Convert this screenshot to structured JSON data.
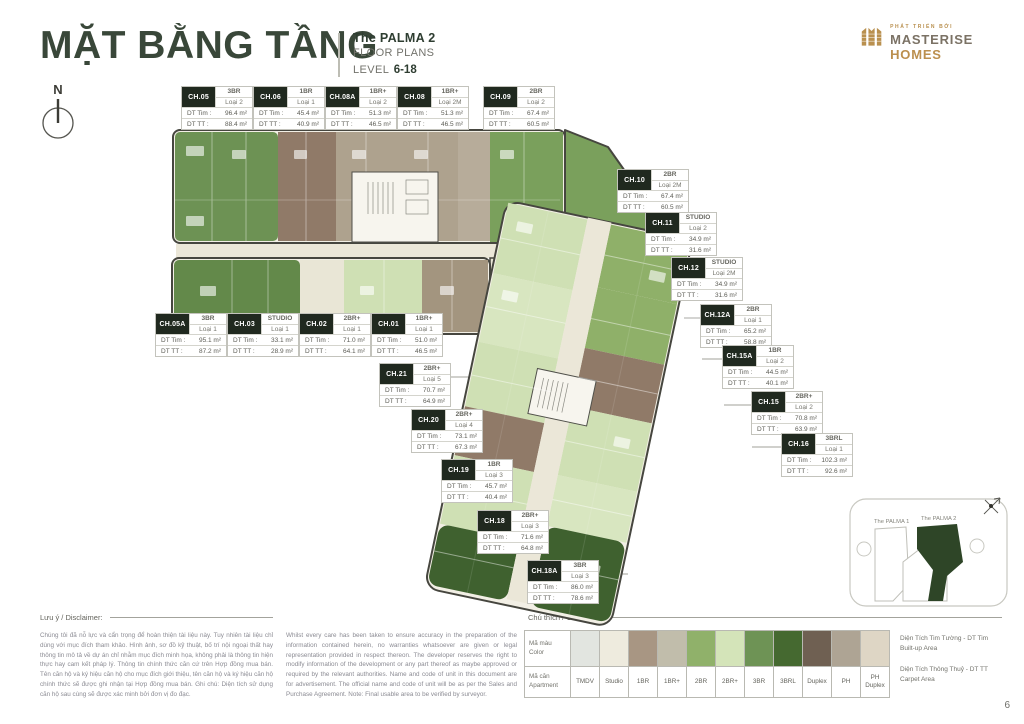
{
  "header": {
    "title": "MẶT BẰNG TẦNG",
    "project_name": "The PALMA 2",
    "subtitle": "FLOOR PLANS",
    "level_label": "LEVEL",
    "level_range": "6-18",
    "logo": {
      "tagline": "PHÁT TRIỂN BỞI",
      "brand_primary": "MASTERISE",
      "brand_secondary": "HOMES",
      "gold_color": "#b9904f"
    }
  },
  "compass_label": "N",
  "plan": {
    "dt_tim_label": "DT Tim :",
    "dt_tt_label": "DT TT :",
    "units": [
      {
        "code": "CH.05",
        "type": "3BR",
        "variant": "Loại 2",
        "dt_tim": "96.4 m²",
        "dt_tt": "88.4 m²"
      },
      {
        "code": "CH.06",
        "type": "1BR",
        "variant": "Loại 1",
        "dt_tim": "45.4 m²",
        "dt_tt": "40.9 m²"
      },
      {
        "code": "CH.08A",
        "type": "1BR+",
        "variant": "Loại 2",
        "dt_tim": "51.3 m²",
        "dt_tt": "46.5 m²"
      },
      {
        "code": "CH.08",
        "type": "1BR+",
        "variant": "Loại 2M",
        "dt_tim": "51.3 m²",
        "dt_tt": "46.5 m²"
      },
      {
        "code": "CH.09",
        "type": "2BR",
        "variant": "Loại 2",
        "dt_tim": "67.4 m²",
        "dt_tt": "60.5 m²"
      },
      {
        "code": "CH.10",
        "type": "2BR",
        "variant": "Loại 2M",
        "dt_tim": "67.4 m²",
        "dt_tt": "60.5 m²"
      },
      {
        "code": "CH.11",
        "type": "STUDIO",
        "variant": "Loại 2",
        "dt_tim": "34.9 m²",
        "dt_tt": "31.6 m²"
      },
      {
        "code": "CH.12",
        "type": "STUDIO",
        "variant": "Loại 2M",
        "dt_tim": "34.9 m²",
        "dt_tt": "31.6 m²"
      },
      {
        "code": "CH.12A",
        "type": "2BR",
        "variant": "Loại 1",
        "dt_tim": "65.2 m²",
        "dt_tt": "58.8 m²"
      },
      {
        "code": "CH.15A",
        "type": "1BR",
        "variant": "Loại 2",
        "dt_tim": "44.5 m²",
        "dt_tt": "40.1 m²"
      },
      {
        "code": "CH.15",
        "type": "2BR+",
        "variant": "Loại 2",
        "dt_tim": "70.8 m²",
        "dt_tt": "63.9 m²"
      },
      {
        "code": "CH.16",
        "type": "3BRL",
        "variant": "Loại 1",
        "dt_tim": "102.3 m²",
        "dt_tt": "92.6 m²"
      },
      {
        "code": "CH.05A",
        "type": "3BR",
        "variant": "Loại 1",
        "dt_tim": "95.1 m²",
        "dt_tt": "87.2 m²"
      },
      {
        "code": "CH.03",
        "type": "STUDIO",
        "variant": "Loại 1",
        "dt_tim": "33.1 m²",
        "dt_tt": "28.9 m²"
      },
      {
        "code": "CH.02",
        "type": "2BR+",
        "variant": "Loại 1",
        "dt_tim": "71.0 m²",
        "dt_tt": "64.1 m²"
      },
      {
        "code": "CH.01",
        "type": "1BR+",
        "variant": "Loại 1",
        "dt_tim": "51.0 m²",
        "dt_tt": "46.5 m²"
      },
      {
        "code": "CH.21",
        "type": "2BR+",
        "variant": "Loại 5",
        "dt_tim": "70.7 m²",
        "dt_tt": "64.9 m²"
      },
      {
        "code": "CH.20",
        "type": "2BR+",
        "variant": "Loại 4",
        "dt_tim": "73.1 m²",
        "dt_tt": "67.3 m²"
      },
      {
        "code": "CH.19",
        "type": "1BR",
        "variant": "Loại 3",
        "dt_tim": "45.7 m²",
        "dt_tt": "40.4 m²"
      },
      {
        "code": "CH.18",
        "type": "2BR+",
        "variant": "Loại 3",
        "dt_tim": "71.6 m²",
        "dt_tt": "64.8 m²"
      },
      {
        "code": "CH.18A",
        "type": "3BR",
        "variant": "Loại 3",
        "dt_tim": "86.0 m²",
        "dt_tt": "78.6 m²"
      }
    ]
  },
  "minimap": {
    "palma1_label": "The PALMA 1",
    "palma2_label": "The PALMA 2",
    "highlight_color": "#2e4527"
  },
  "disclaimer": {
    "title": "Lưu ý / Disclaimer:",
    "vietnamese": "Chúng tôi đã nỗ lực và cẩn trọng để hoàn thiện tài liệu này. Tuy nhiên tài liệu chỉ dùng với mục đích tham khảo. Hình ảnh, sơ đồ kỹ thuật, bố trí nội ngoại thất hay thông tin mô tả về dự án chỉ nhằm mục đích minh họa, không phải là thông tin hiện thực hay cam kết pháp lý. Thông tin chính thức căn cứ trên Hợp đồng mua bán. Tên căn hộ và ký hiệu căn hộ cho mục đích giới thiệu, tên căn hộ và ký hiệu căn hộ chính thức sẽ được ghi nhận tại Hợp đồng mua bán. Ghi chú: Diện tích sử dụng căn hộ sau cùng sẽ được xác minh bởi đơn vị đo đạc.",
    "english": "Whilst every care has been taken to ensure accuracy in the preparation of the information contained herein, no warranties whatsoever are given or legal representation provided in respect thereon. The developer reserves the right to modify information of the development or any part thereof as maybe approved or required by the relevant authorities. Name and code of unit in this document are for advertisement. The official name and code of unit will be as per the Sales and Purchase Agreement. Note: Final usable area to be verified by surveyor."
  },
  "legend": {
    "title": "Chú thích / Comment",
    "color_row_label_vi": "Mã màu",
    "color_row_label_en": "Color",
    "apartment_row_label_vi": "Mã căn",
    "apartment_row_label_en": "Apartment",
    "items": [
      {
        "label": "TMDV",
        "color": "#e2e5e0"
      },
      {
        "label": "Studio",
        "color": "#eeebde"
      },
      {
        "label": "1BR",
        "color": "#a89683"
      },
      {
        "label": "1BR+",
        "color": "#c1bdab"
      },
      {
        "label": "2BR",
        "color": "#90b16a"
      },
      {
        "label": "2BR+",
        "color": "#d4e4b9"
      },
      {
        "label": "3BR",
        "color": "#6e9355"
      },
      {
        "label": "3BRL",
        "color": "#456930"
      },
      {
        "label": "Duplex",
        "color": "#6f6052"
      },
      {
        "label": "PH",
        "color": "#aea494"
      },
      {
        "label": "PH Duplex",
        "color": "#ded6c5"
      }
    ],
    "notes": [
      {
        "vi": "Diện Tích Tim Tường - DT Tim",
        "en": "Built-up Area"
      },
      {
        "vi": "Diện Tích Thông Thuỷ - DT TT",
        "en": "Carpet Area"
      }
    ]
  },
  "footer": {
    "page_number": "6"
  }
}
